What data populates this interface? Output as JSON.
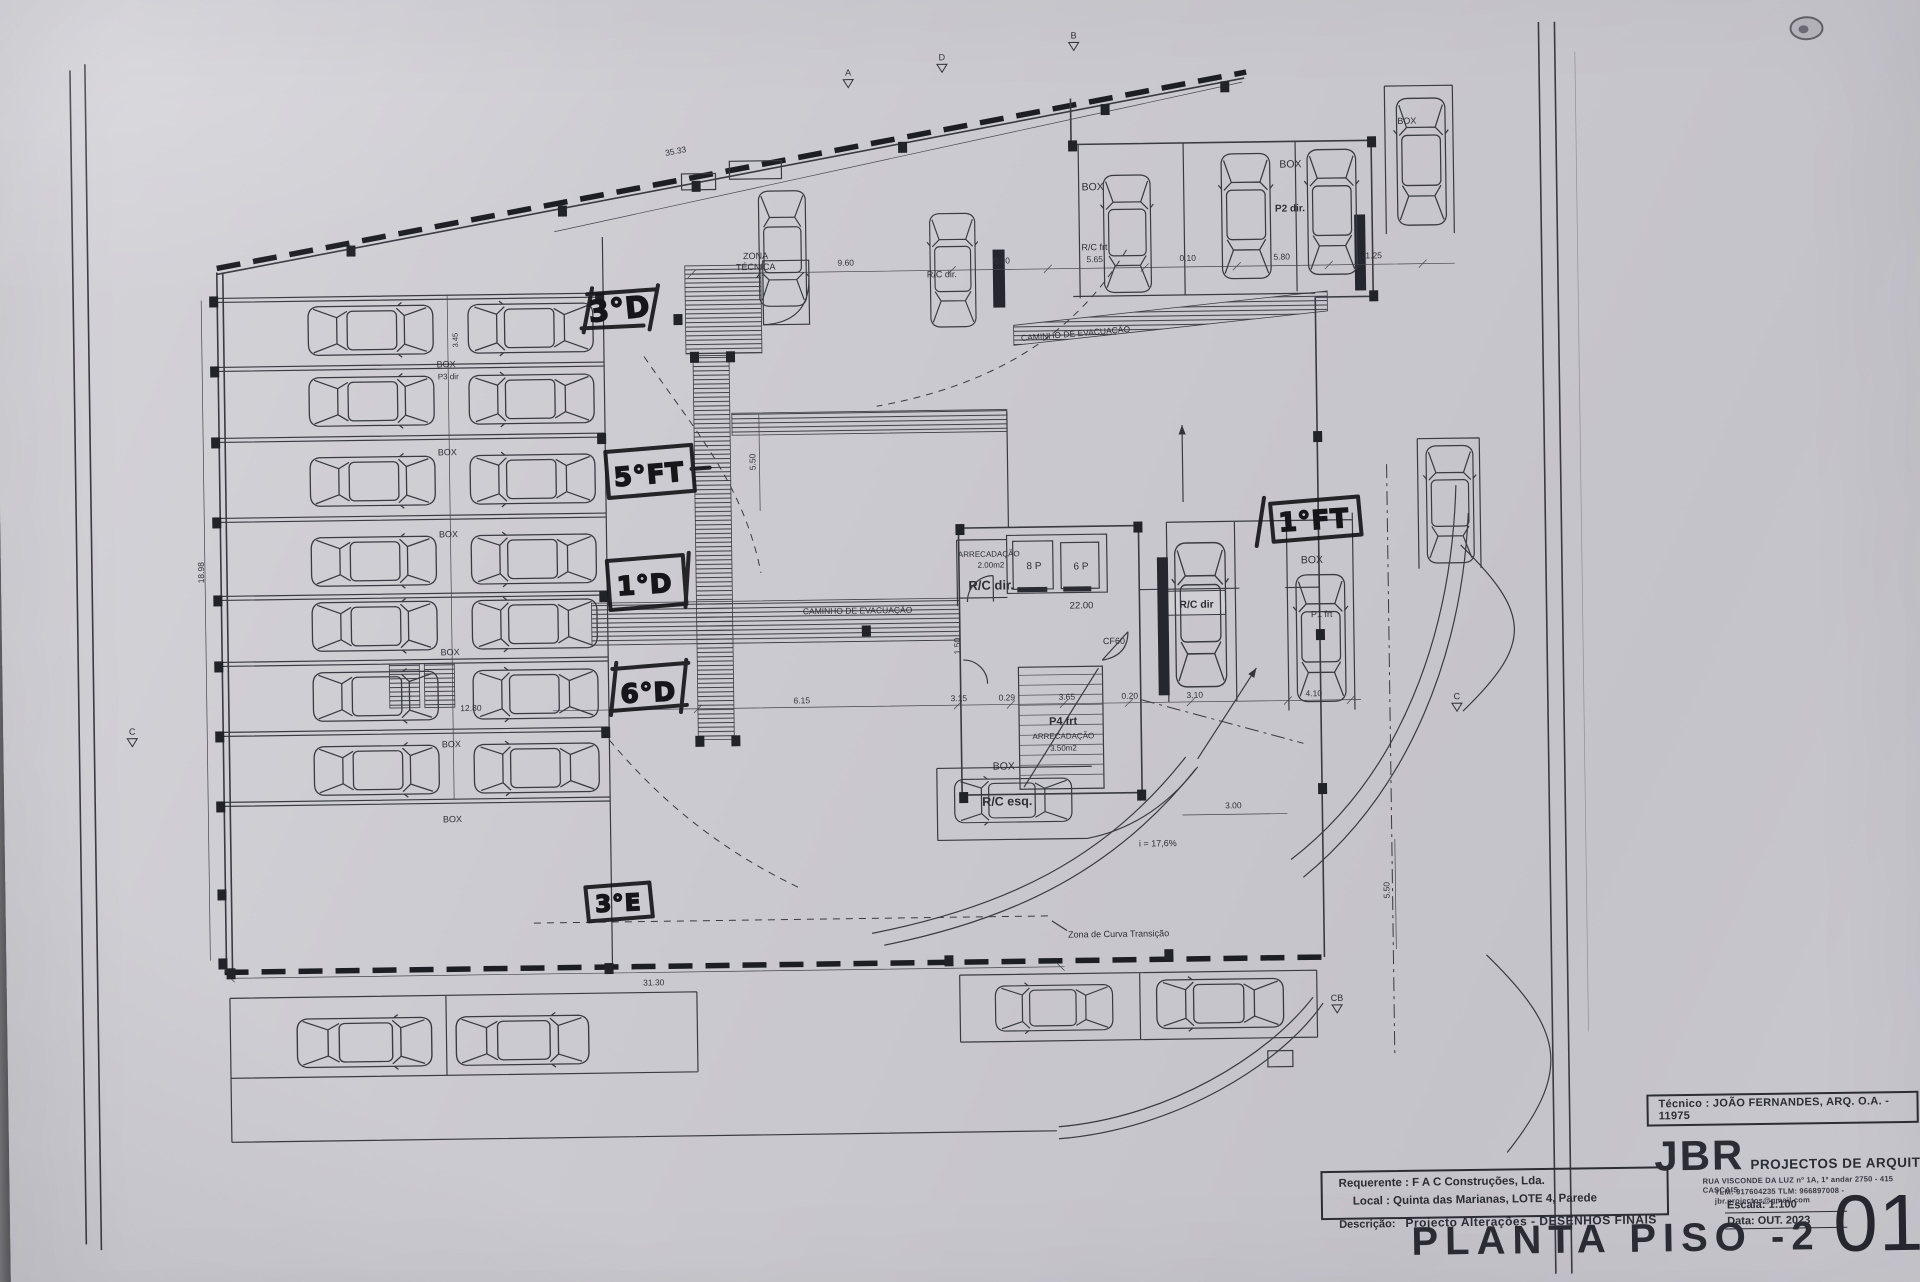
{
  "colors": {
    "paper": "#cbcad0",
    "ink": "#33333b",
    "ink_heavy": "#1d1d24",
    "marker": "#16161a"
  },
  "title_block": {
    "tecnico": "Técnico : JOÃO FERNANDES, ARQ.   O.A. - 11975",
    "firm_name": "JBR",
    "firm_tagline": "PROJECTOS DE ARQUITECTURA",
    "firm_address": "RUA VISCONDE DA LUZ nº 1A, 1º andar   2750 - 415   CASCAIS",
    "firm_contacts": "TLM: 917604235  TLM: 966897008 - jbr.projectos@gmail.com",
    "requerente": "Requerente : F A C  Construções, Lda.",
    "local": "Local : Quinta das Marianas, LOTE 4, Parede",
    "descricao_label": "Descrição:",
    "descricao_value": "Projecto Alterações - DESENHOS FINAIS",
    "escala": "Escala:  1:100",
    "data": "Data: OUT.  2023",
    "drawing_title": "PLANTA PISO -2",
    "sheet_number": "01"
  },
  "plan": {
    "texts": [
      {
        "t": "ZONA",
        "x": 761,
        "y": 256,
        "s": 9,
        "n": "zona-tecnica-label"
      },
      {
        "t": "TÉCNICA",
        "x": 761,
        "y": 267,
        "s": 9,
        "n": "zona-tecnica-label"
      },
      {
        "t": "CAMINHO  DE  EVACUAÇÃO",
        "x": 858,
        "y": 612,
        "s": 8.5,
        "n": "evacuation-path-label"
      },
      {
        "t": "CAMINHO  DE  EVACUAÇÃO",
        "x": 1080,
        "y": 338,
        "s": 8.5,
        "r": -4,
        "n": "evacuation-path-label"
      },
      {
        "t": "ARRECADAÇÃO",
        "x": 990,
        "y": 557,
        "s": 8
      },
      {
        "t": "2.00m2",
        "x": 992,
        "y": 568,
        "s": 8
      },
      {
        "t": "R/C dir.",
        "x": 992,
        "y": 590,
        "s": 13,
        "b": 1
      },
      {
        "t": "8 P",
        "x": 1035,
        "y": 570,
        "s": 10,
        "n": "elevator-label"
      },
      {
        "t": "6 P",
        "x": 1082,
        "y": 571,
        "s": 10,
        "n": "elevator-label"
      },
      {
        "t": "22.00",
        "x": 1082,
        "y": 610,
        "s": 9.5,
        "n": "level-label"
      },
      {
        "t": "CF60",
        "x": 1114,
        "y": 646,
        "s": 9
      },
      {
        "t": "P4 frt",
        "x": 1062,
        "y": 726,
        "s": 11,
        "b": 1
      },
      {
        "t": "ARRECADAÇÃO",
        "x": 1062,
        "y": 740,
        "s": 8
      },
      {
        "t": "3.50m2",
        "x": 1062,
        "y": 752,
        "s": 8
      },
      {
        "t": "BOX",
        "x": 1002,
        "y": 770,
        "s": 10.5
      },
      {
        "t": "R/C esq.",
        "x": 1005,
        "y": 806,
        "s": 12.5,
        "b": 1
      },
      {
        "t": "R/C dir",
        "x": 1197,
        "y": 611,
        "s": 10.5,
        "b": 1
      },
      {
        "t": "R/C dir.",
        "x": 947,
        "y": 277,
        "s": 9
      },
      {
        "t": "BOX",
        "x": 1099,
        "y": 192,
        "s": 10.5
      },
      {
        "t": "R/C frt",
        "x": 1100,
        "y": 252,
        "s": 9
      },
      {
        "t": "BOX",
        "x": 1297,
        "y": 172,
        "s": 10.5
      },
      {
        "t": "P2 dir.",
        "x": 1296,
        "y": 216,
        "s": 10,
        "b": 1
      },
      {
        "t": "BOX",
        "x": 1313,
        "y": 568,
        "s": 10.5
      },
      {
        "t": "P1 frt",
        "x": 1322,
        "y": 622,
        "s": 9
      },
      {
        "t": "BOX",
        "x": 1414,
        "y": 130,
        "s": 9
      },
      {
        "t": "BOX",
        "x": 450,
        "y": 360,
        "s": 9
      },
      {
        "t": "P3 dir",
        "x": 452,
        "y": 372,
        "s": 8
      },
      {
        "t": "BOX",
        "x": 450,
        "y": 448,
        "s": 9
      },
      {
        "t": "BOX",
        "x": 450,
        "y": 530,
        "s": 9
      },
      {
        "t": "BOX",
        "x": 450,
        "y": 648,
        "s": 9
      },
      {
        "t": "BOX",
        "x": 450,
        "y": 740,
        "s": 9
      },
      {
        "t": "BOX",
        "x": 450,
        "y": 815,
        "s": 9
      },
      {
        "t": "i = 17,6%",
        "x": 1155,
        "y": 849,
        "s": 9,
        "n": "ramp-slope-label"
      },
      {
        "t": "Zona de Curva Transição",
        "x": 1064,
        "y": 939,
        "s": 9,
        "a": "s",
        "n": "transition-curve-label"
      },
      {
        "t": "35.33",
        "x": 683,
        "y": 150,
        "r": -10,
        "d": 1
      },
      {
        "t": "9.60",
        "x": 851,
        "y": 264,
        "d": 1
      },
      {
        "t": "0.90",
        "x": 1007,
        "y": 264,
        "d": 1
      },
      {
        "t": "5.65",
        "x": 1100,
        "y": 264,
        "d": 1
      },
      {
        "t": "0.10",
        "x": 1193,
        "y": 264,
        "d": 1
      },
      {
        "t": "5.80",
        "x": 1287,
        "y": 264,
        "d": 1
      },
      {
        "t": "1.25",
        "x": 1379,
        "y": 264,
        "d": 1
      },
      {
        "t": "18.98",
        "x": 205,
        "y": 562,
        "r": -90,
        "d": 1
      },
      {
        "t": "3.45",
        "x": 462,
        "y": 333,
        "r": -90,
        "s": 7.5,
        "d": 1
      },
      {
        "t": "12.80",
        "x": 470,
        "y": 704,
        "d": 1
      },
      {
        "t": "6.15",
        "x": 801,
        "y": 701,
        "d": 1
      },
      {
        "t": "3.15",
        "x": 958,
        "y": 701,
        "d": 1
      },
      {
        "t": "0.29",
        "x": 1006,
        "y": 701,
        "d": 1
      },
      {
        "t": "3.65",
        "x": 1066,
        "y": 701,
        "d": 1
      },
      {
        "t": "0.20",
        "x": 1129,
        "y": 701,
        "d": 1
      },
      {
        "t": "3.10",
        "x": 1194,
        "y": 701,
        "d": 1
      },
      {
        "t": "4.10",
        "x": 1313,
        "y": 701,
        "d": 1
      },
      {
        "t": "3.00",
        "x": 1231,
        "y": 812,
        "d": 1
      },
      {
        "t": "5.50",
        "x": 1386,
        "y": 896,
        "r": -90,
        "d": 1
      },
      {
        "t": "5.50",
        "x": 758,
        "y": 459,
        "r": -90,
        "d": 1
      },
      {
        "t": "1.50",
        "x": 960,
        "y": 646,
        "r": -90,
        "d": 1
      },
      {
        "t": "31.30",
        "x": 649,
        "y": 981,
        "d": 1
      }
    ],
    "handwritten": [
      {
        "t": "3°D",
        "x": 625,
        "y": 314,
        "s": 29,
        "r": -5,
        "strokes": "M592,289 L660,285 M586,323 L648,321 M597,283 L588,327 M663,281 L654,325"
      },
      {
        "t": "5°FT",
        "x": 652,
        "y": 479,
        "s": 26,
        "r": -4,
        "strokes": "M608,447 L694,441 L697,487 L611,493 Z M694,465 L712,464"
      },
      {
        "t": "1°D",
        "x": 646,
        "y": 589,
        "s": 26,
        "r": -3,
        "strokes": "M608,556 L684,551 L687,600 L611,605 Z M690,549 L686,603"
      },
      {
        "t": "6°D",
        "x": 648,
        "y": 697,
        "s": 26,
        "r": -2,
        "strokes": "M612,664 L688,659 M610,706 L686,701 M616,658 L610,710 M686,656 L680,708"
      },
      {
        "t": "3°E",
        "x": 615,
        "y": 906,
        "s": 23,
        "r": -2,
        "strokes": "M582,882 L646,878 L649,912 L585,916 Z"
      },
      {
        "t": "1°FT",
        "x": 1316,
        "y": 534,
        "s": 26,
        "r": -3,
        "strokes": "M1272,508 L1360,502 L1363,540 L1275,546 Z M1266,502 L1258,550"
      }
    ],
    "markers": [
      {
        "t": "A",
        "x": 856,
        "y": 74
      },
      {
        "t": "D",
        "x": 950,
        "y": 60
      },
      {
        "t": "B",
        "x": 1082,
        "y": 40
      },
      {
        "t": "C",
        "x": 131,
        "y": 723
      },
      {
        "t": "C",
        "x": 1456,
        "y": 706
      },
      {
        "t": "CB",
        "x": 1332,
        "y": 1006
      }
    ],
    "cars": [
      {
        "x": 375,
        "y": 322,
        "l": 130,
        "w": 56,
        "a": 180
      },
      {
        "x": 375,
        "y": 393,
        "l": 130,
        "w": 56,
        "a": 180
      },
      {
        "x": 375,
        "y": 473,
        "l": 130,
        "w": 56,
        "a": 180
      },
      {
        "x": 375,
        "y": 553,
        "l": 130,
        "w": 56,
        "a": 180
      },
      {
        "x": 375,
        "y": 618,
        "l": 130,
        "w": 56,
        "a": 180
      },
      {
        "x": 375,
        "y": 688,
        "l": 130,
        "w": 56,
        "a": 180
      },
      {
        "x": 375,
        "y": 762,
        "l": 130,
        "w": 56,
        "a": 180
      },
      {
        "x": 535,
        "y": 322,
        "l": 130,
        "w": 56,
        "a": 0
      },
      {
        "x": 535,
        "y": 393,
        "l": 130,
        "w": 56,
        "a": 0
      },
      {
        "x": 535,
        "y": 473,
        "l": 130,
        "w": 56,
        "a": 0
      },
      {
        "x": 535,
        "y": 553,
        "l": 130,
        "w": 56,
        "a": 0
      },
      {
        "x": 535,
        "y": 618,
        "l": 130,
        "w": 56,
        "a": 0
      },
      {
        "x": 535,
        "y": 688,
        "l": 130,
        "w": 56,
        "a": 0
      },
      {
        "x": 535,
        "y": 762,
        "l": 130,
        "w": 56,
        "a": 0
      },
      {
        "x": 788,
        "y": 246,
        "l": 120,
        "w": 54,
        "a": -90
      },
      {
        "x": 958,
        "y": 270,
        "l": 118,
        "w": 52,
        "a": 90
      },
      {
        "x": 1133,
        "y": 236,
        "l": 122,
        "w": 54,
        "a": 90
      },
      {
        "x": 1252,
        "y": 220,
        "l": 130,
        "w": 56,
        "a": 90
      },
      {
        "x": 1338,
        "y": 217,
        "l": 130,
        "w": 56,
        "a": 90
      },
      {
        "x": 1201,
        "y": 618,
        "l": 150,
        "w": 58,
        "a": 90
      },
      {
        "x": 1321,
        "y": 643,
        "l": 132,
        "w": 56,
        "a": 90
      },
      {
        "x": 1452,
        "y": 511,
        "l": 122,
        "w": 54,
        "a": 90
      },
      {
        "x": 1428,
        "y": 168,
        "l": 132,
        "w": 56,
        "a": 90
      },
      {
        "x": 359,
        "y": 1034,
        "l": 140,
        "w": 56,
        "a": 180
      },
      {
        "x": 517,
        "y": 1034,
        "l": 138,
        "w": 56,
        "a": 180
      },
      {
        "x": 1049,
        "y": 1009,
        "l": 122,
        "w": 52,
        "a": 0
      },
      {
        "x": 1215,
        "y": 1007,
        "l": 132,
        "w": 56,
        "a": 0
      },
      {
        "x": 1011,
        "y": 801,
        "l": 122,
        "w": 50,
        "a": 0
      }
    ],
    "squares": [
      [
        214,
        286
      ],
      [
        214,
        356
      ],
      [
        214,
        427
      ],
      [
        214,
        507
      ],
      [
        214,
        585
      ],
      [
        214,
        651
      ],
      [
        214,
        721
      ],
      [
        214,
        791
      ],
      [
        214,
        879
      ],
      [
        214,
        948
      ],
      [
        352,
        237
      ],
      [
        564,
        200
      ],
      [
        698,
        177
      ],
      [
        905,
        141
      ],
      [
        1108,
        106
      ],
      [
        1228,
        85
      ],
      [
        678,
        310
      ],
      [
        694,
        348
      ],
      [
        730,
        348
      ],
      [
        694,
        732
      ],
      [
        730,
        732
      ],
      [
        957,
        524
      ],
      [
        1135,
        524
      ],
      [
        957,
        792
      ],
      [
        1135,
        792
      ],
      [
        1316,
        436
      ],
      [
        1316,
        634
      ],
      [
        1316,
        788
      ],
      [
        1075,
        142
      ],
      [
        1374,
        142
      ],
      [
        1374,
        296
      ],
      [
        862,
        624
      ],
      [
        600,
        288
      ],
      [
        600,
        428
      ],
      [
        600,
        586
      ],
      [
        600,
        722
      ],
      [
        600,
        958
      ],
      [
        222,
        958
      ],
      [
        940,
        955
      ],
      [
        1160,
        952
      ]
    ]
  }
}
